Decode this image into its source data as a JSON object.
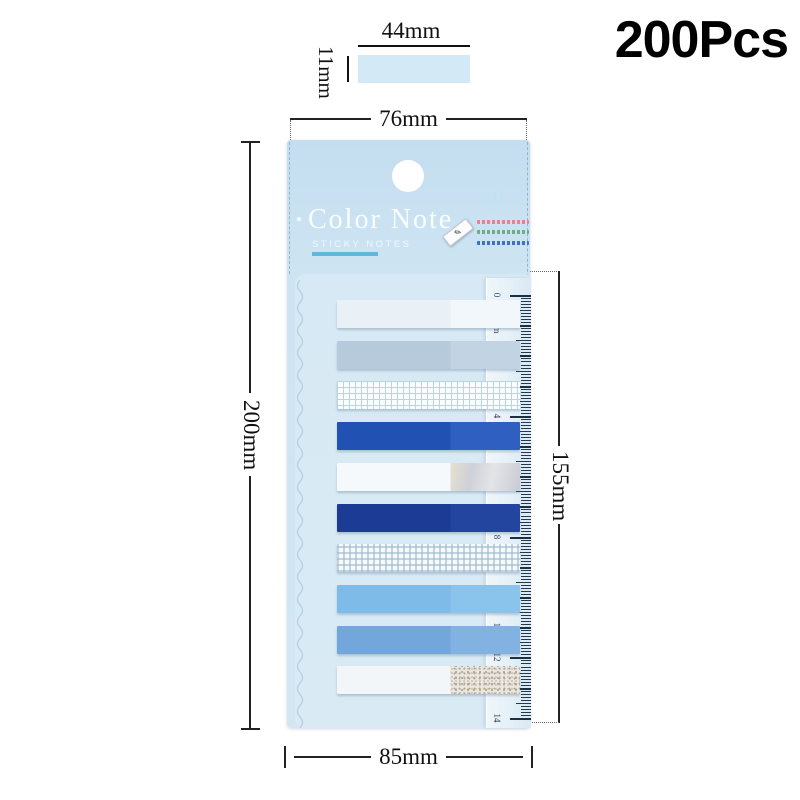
{
  "badge": {
    "count_label": "200Pcs"
  },
  "swatch": {
    "width_label": "44mm",
    "height_label": "11mm",
    "color": "#d3e9f6"
  },
  "dimensions": {
    "top_width": "76mm",
    "left_height": "200mm",
    "right_height": "155mm",
    "bottom_width": "85mm"
  },
  "card": {
    "title": "Color Note",
    "subtitle": "STICKY NOTES",
    "colors_count": "10",
    "colors_label": "colors",
    "accent_color": "#5fb7dd",
    "pen_icon": "✎",
    "fine_print_colors": [
      "#e8818f",
      "#6fae85",
      "#3f6fc8"
    ]
  },
  "ruler": {
    "unit": "cm",
    "numbers": [
      "0",
      "1cm",
      "2",
      "3",
      "4",
      "5",
      "6",
      "7",
      "8",
      "9",
      "10",
      "11",
      "12",
      "13",
      "14"
    ]
  },
  "strips": [
    {
      "name": "pale-white-blue-tab",
      "type": "solid",
      "left": "#e9f1f7",
      "right": "#f1f7fb"
    },
    {
      "name": "pale-gray-blue-tab",
      "type": "solid",
      "left": "#b6cadb",
      "right": "#c2d4e3"
    },
    {
      "name": "blue-grid-tab",
      "type": "grid",
      "base": "#fbfdfe",
      "line": "#b7d4e8"
    },
    {
      "name": "royal-blue-tab",
      "type": "solid",
      "left": "#2251b4",
      "right": "#2f5fc0"
    },
    {
      "name": "white-holographic-tab",
      "type": "holo",
      "left": "#f6f9fb"
    },
    {
      "name": "navy-blue-tab",
      "type": "solid",
      "left": "#1c3b95",
      "right": "#24459f"
    },
    {
      "name": "gingham-check-tab",
      "type": "gingham",
      "base": "#f6fafc",
      "line": "#a0b9cd"
    },
    {
      "name": "sky-blue-tab",
      "type": "solid",
      "left": "#7ebbe8",
      "right": "#8ac3ec"
    },
    {
      "name": "medium-blue-tab",
      "type": "solid",
      "left": "#73a7db",
      "right": "#81b2e1"
    },
    {
      "name": "white-glitter-tab",
      "type": "glitter",
      "left": "#f3f6f8"
    }
  ]
}
